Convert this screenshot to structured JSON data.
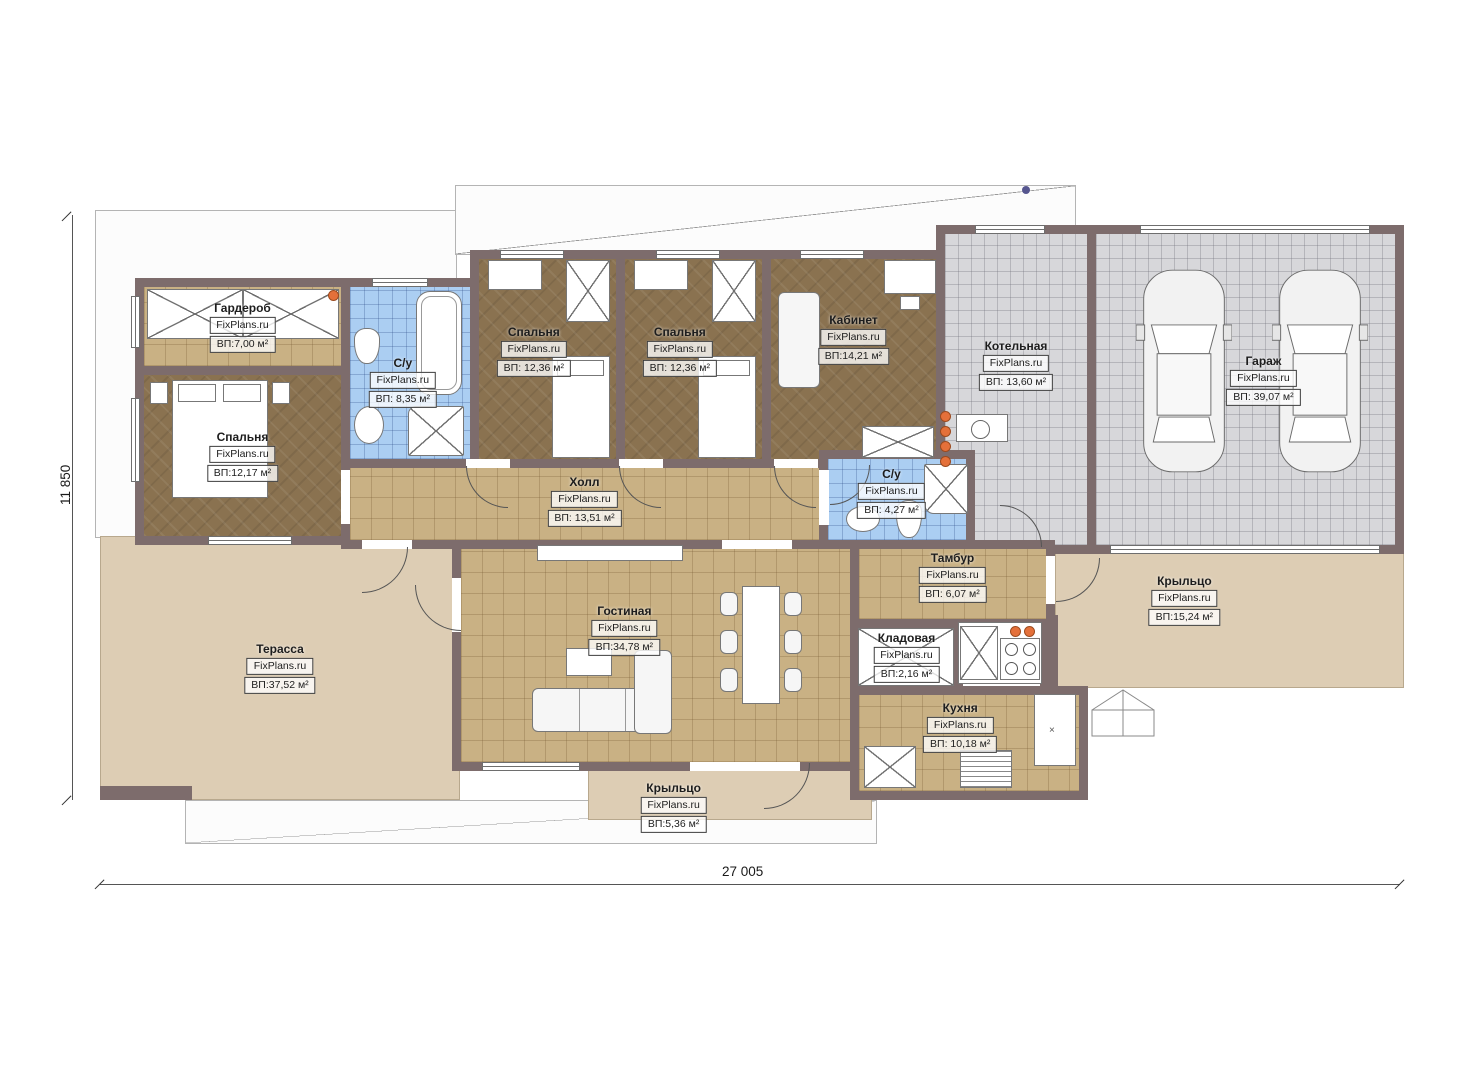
{
  "plan": {
    "watermark": "FixPlans.ru",
    "rooms": [
      {
        "id": "garderob",
        "name": "Гардероб",
        "watermark": "FixPlans.ru",
        "area": "ВП:7,00 м²"
      },
      {
        "id": "bedroom-1",
        "name": "Спальня",
        "watermark": "FixPlans.ru",
        "area": "ВП:12,17 м²"
      },
      {
        "id": "bath-1",
        "name": "С/у",
        "watermark": "FixPlans.ru",
        "area": "ВП: 8,35 м²"
      },
      {
        "id": "bedroom-2",
        "name": "Спальня",
        "watermark": "FixPlans.ru",
        "area": "ВП: 12,36 м²"
      },
      {
        "id": "bedroom-3",
        "name": "Спальня",
        "watermark": "FixPlans.ru",
        "area": "ВП: 12,36 м²"
      },
      {
        "id": "office",
        "name": "Кабинет",
        "watermark": "FixPlans.ru",
        "area": "ВП:14,21 м²"
      },
      {
        "id": "boiler",
        "name": "Котельная",
        "watermark": "FixPlans.ru",
        "area": "ВП: 13,60 м²"
      },
      {
        "id": "garage",
        "name": "Гараж",
        "watermark": "FixPlans.ru",
        "area": "ВП: 39,07 м²"
      },
      {
        "id": "hall",
        "name": "Холл",
        "watermark": "FixPlans.ru",
        "area": "ВП: 13,51 м²"
      },
      {
        "id": "bath-2",
        "name": "С/у",
        "watermark": "FixPlans.ru",
        "area": "ВП: 4,27 м²"
      },
      {
        "id": "vestibule",
        "name": "Тамбур",
        "watermark": "FixPlans.ru",
        "area": "ВП: 6,07 м²"
      },
      {
        "id": "storeroom",
        "name": "Кладовая",
        "watermark": "FixPlans.ru",
        "area": "ВП:2,16 м²"
      },
      {
        "id": "kitchen",
        "name": "Кухня",
        "watermark": "FixPlans.ru",
        "area": "ВП: 10,18 м²"
      },
      {
        "id": "living",
        "name": "Гостиная",
        "watermark": "FixPlans.ru",
        "area": "ВП:34,78 м²"
      },
      {
        "id": "terrace",
        "name": "Терасса",
        "watermark": "FixPlans.ru",
        "area": "ВП:37,52 м²"
      },
      {
        "id": "porch-right",
        "name": "Крыльцо",
        "watermark": "FixPlans.ru",
        "area": "ВП:15,24 м²"
      },
      {
        "id": "porch-bottom",
        "name": "Крыльцо",
        "watermark": "FixPlans.ru",
        "area": "ВП:5,36 м²"
      }
    ],
    "dimensions": {
      "width": "27 005",
      "height": "11 850"
    },
    "colors": {
      "wall": "#7d6c6c",
      "wood_floor": "#8a7250",
      "tile_tan": "#c9b184",
      "tile_blue": "#abcef2",
      "tile_gray": "#d7d7da",
      "terrace": "#ddcdb4",
      "outlet": "#e4703a"
    }
  }
}
